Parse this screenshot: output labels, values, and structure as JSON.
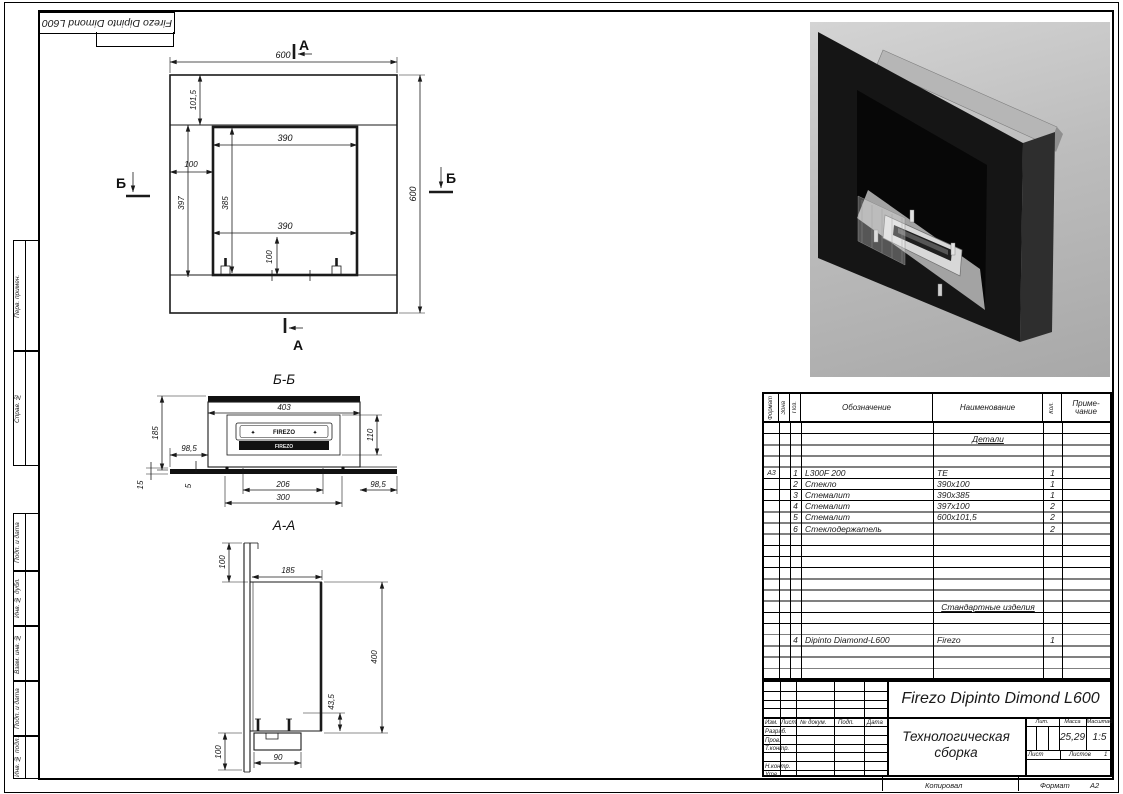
{
  "stamp": {
    "rotated_designation": "Firezo Dipinto Dimond L600"
  },
  "side_strips": {
    "perv_primen": "Перв. примен.",
    "sprav_no": "Справ. №",
    "podp_data_1": "Подп. и дата",
    "inv_dubl": "Инв. № дубл.",
    "vzam_inv": "Взам. инв. №",
    "podp_data_2": "Подп. и дата",
    "inv_podl": "Инв. № подл."
  },
  "front_view": {
    "marker_a": "А",
    "marker_b": "Б",
    "dim_width_top": "600",
    "dim_glass_top": "101,5",
    "dim_opening_w_top": "390",
    "dim_side_band": "100",
    "dim_side_h": "397",
    "dim_opening_h": "385",
    "dim_opening_w_bottom": "390",
    "dim_bottom_offset": "100",
    "dim_height_right": "600"
  },
  "section_bb": {
    "title": "Б-Б",
    "dim_403": "403",
    "dim_185": "185",
    "dim_985_left": "98,5",
    "dim_110": "110",
    "dim_15": "15",
    "dim_5": "5",
    "dim_206": "206",
    "dim_300": "300",
    "dim_985_right": "98,5",
    "burner_top_label": "FIREZO",
    "burner_slot_label": "FIREZO"
  },
  "section_aa": {
    "title": "А-А",
    "dim_100_top": "100",
    "dim_185": "185",
    "dim_400": "400",
    "dim_435": "43,5",
    "dim_100_bottom": "100",
    "dim_90": "90"
  },
  "spec_table": {
    "col_format": "Формат",
    "col_zona": "Зона",
    "col_poz": "Поз.",
    "col_oboznachenie": "Обозначение",
    "col_naimenovanie": "Наименование",
    "col_kol": "Кол.",
    "col_prim_line1": "Приме-",
    "col_prim_line2": "чание",
    "section_details": "Детали",
    "section_standard": "Стандартные изделия",
    "rows": [
      {
        "format": "А3",
        "poz": "1",
        "oboznachenie": "L300F 200",
        "naimenovanie": "ТЕ",
        "kol": "1"
      },
      {
        "format": "",
        "poz": "2",
        "oboznachenie": "Стекло",
        "naimenovanie": "390х100",
        "kol": "1"
      },
      {
        "format": "",
        "poz": "3",
        "oboznachenie": "Стемалит",
        "naimenovanie": "390х385",
        "kol": "1"
      },
      {
        "format": "",
        "poz": "4",
        "oboznachenie": "Стемалит",
        "naimenovanie": "397х100",
        "kol": "2"
      },
      {
        "format": "",
        "poz": "5",
        "oboznachenie": "Стемалит",
        "naimenovanie": "600х101,5",
        "kol": "2"
      },
      {
        "format": "",
        "poz": "6",
        "oboznachenie": "Стеклодержатель",
        "naimenovanie": "",
        "kol": "2"
      }
    ],
    "standard_rows": [
      {
        "poz": "4",
        "oboznachenie": "Dipinto Diamond-L600",
        "naimenovanie": "Firezo",
        "kol": "1"
      }
    ]
  },
  "title_block": {
    "doc_name": "Firezo Dipinto Dimond L600",
    "doc_type_line1": "Технологическая",
    "doc_type_line2": "сборка",
    "izm": "Изм.",
    "list": "Лист",
    "n_dokum": "№ докум.",
    "podp": "Подп.",
    "data": "Дата",
    "razrab": "Разраб.",
    "prov": "Пров.",
    "t_kontr": "Т.контр.",
    "n_kontr": "Н.контр.",
    "utv": "Утв.",
    "lit": "Лит.",
    "massa": "Масса",
    "masshtab": "Масштаб",
    "massa_value": "25,29",
    "masshtab_value": "1:5",
    "list2": "Лист",
    "listov": "Листов",
    "listov_value": "1",
    "kopiroval": "Копировал",
    "format_label": "Формат",
    "format_value": "А2"
  }
}
